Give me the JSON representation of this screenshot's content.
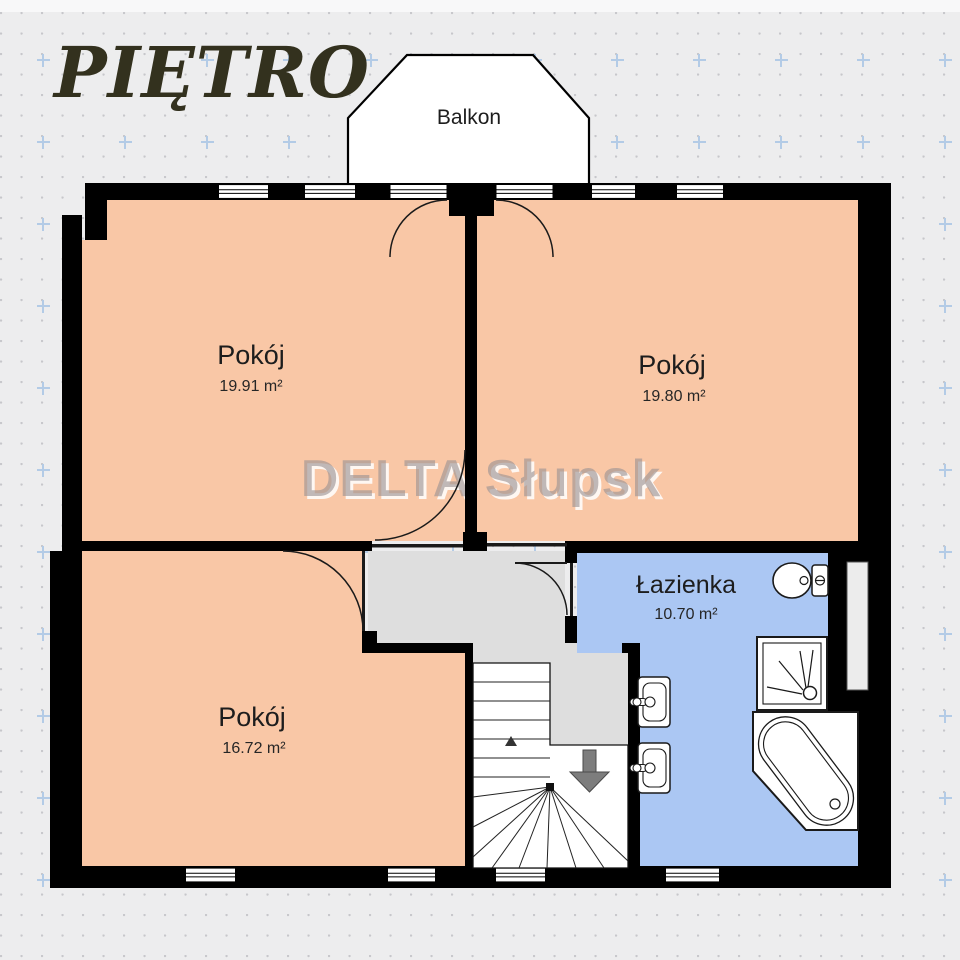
{
  "header": {
    "title": "PIĘTRO"
  },
  "watermark": {
    "text": "DELTA Słupsk"
  },
  "balcony": {
    "label": "Balkon"
  },
  "rooms": [
    {
      "id": "room-top-left",
      "name": "Pokój",
      "area": "19.91 m²"
    },
    {
      "id": "room-top-right",
      "name": "Pokój",
      "area": "19.80 m²"
    },
    {
      "id": "room-bottom-left",
      "name": "Pokój",
      "area": "16.72 m²"
    },
    {
      "id": "bathroom",
      "name": "Łazienka",
      "area": "10.70 m²"
    }
  ],
  "colors": {
    "room_fill": "#f9c7a6",
    "bathroom_fill": "#abc7f3",
    "hall_fill": "#dedede",
    "wall": "#000000",
    "background": "#ededee",
    "title_color": "#33311e",
    "grid_cross": "#b3cbe6",
    "stairs_arrow": "#7d7d7d"
  }
}
